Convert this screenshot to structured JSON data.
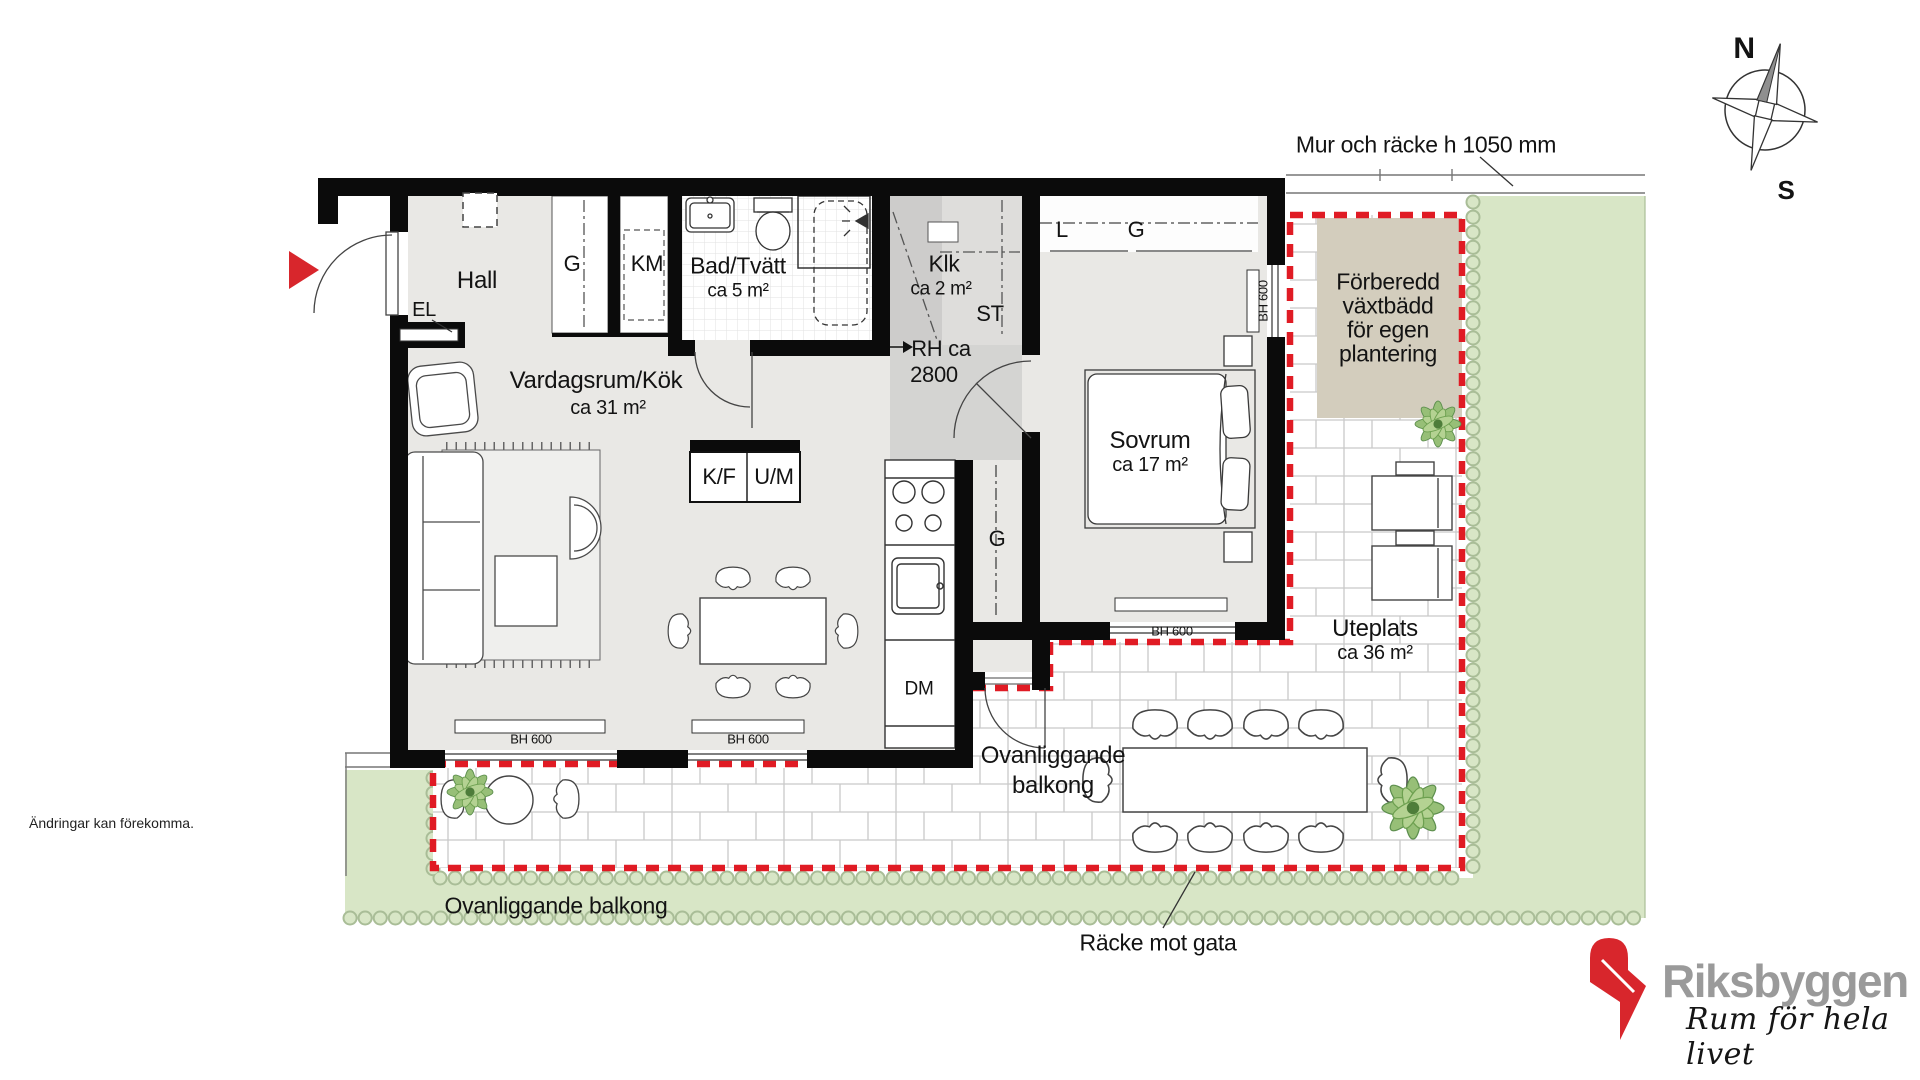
{
  "rooms": {
    "hall": {
      "name": "Hall"
    },
    "living": {
      "name": "Vardagsrum/Kök",
      "area": "ca 31 m²"
    },
    "bath": {
      "name": "Bad/Tvätt",
      "area": "ca 5 m²"
    },
    "closet": {
      "name": "Klk",
      "area": "ca 2 m²"
    },
    "bedroom": {
      "name": "Sovrum",
      "area": "ca 17 m²"
    },
    "patio": {
      "name": "Uteplats",
      "area": "ca 36 m²"
    }
  },
  "fixtures": {
    "el": "EL",
    "wardrobe": "G",
    "washer": "KM",
    "storage": "ST",
    "linen": "L",
    "fridge_freezer": "K/F",
    "oven_micro": "U/M",
    "dishwasher": "DM",
    "ceiling_height_1": "RH ca",
    "ceiling_height_2": "2800",
    "window_height": "BH 600"
  },
  "annotations": {
    "wall_railing": "Mur och räcke h 1050 mm",
    "street_railing": "Räcke mot gata",
    "balcony_above_line1": "Ovanliggande",
    "balcony_above_line2": "balkong",
    "balcony_above_full": "Ovanliggande balkong",
    "planting_line1": "Förberedd",
    "planting_line2": "växtbädd",
    "planting_line3": "för egen",
    "planting_line4": "plantering",
    "disclaimer": "Ändringar kan förekomma."
  },
  "compass": {
    "north": "N",
    "south": "S"
  },
  "brand": {
    "name": "Riksbyggen",
    "tagline": "Rum för hela livet"
  },
  "colors": {
    "accent_red": "#d8262c",
    "boundary_red": "#e01b24",
    "wall": "#0b0b0b",
    "floor": "#e9e8e5",
    "zone_gray": "#d4d4d2",
    "lawn": "#d8e6c6",
    "planting_bed": "#d3cdbd",
    "brand_gray": "#9a9a9a"
  }
}
